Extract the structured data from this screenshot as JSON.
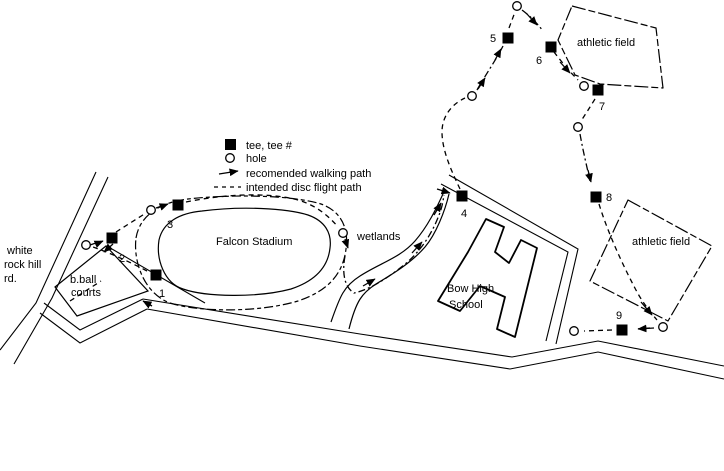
{
  "colors": {
    "ink": "#000000",
    "background": "#ffffff"
  },
  "legend": {
    "text_x": 246,
    "icon_x": 225,
    "items": [
      {
        "type": "tee",
        "label": "tee, tee #",
        "y": 149
      },
      {
        "type": "hole",
        "label": "hole",
        "y": 162
      },
      {
        "type": "walk",
        "label": "recomended walking path",
        "y": 177
      },
      {
        "type": "flight",
        "label": "intended disc flight path",
        "y": 191
      }
    ]
  },
  "map": {
    "labels": [
      {
        "name": "road-name-line-1",
        "text": "white",
        "x": 7,
        "y": 254
      },
      {
        "name": "road-name-line-2",
        "text": "rock hill",
        "x": 4,
        "y": 268
      },
      {
        "name": "road-name-line-3",
        "text": "rd.",
        "x": 4,
        "y": 282
      },
      {
        "name": "bball-courts-label-1",
        "text": "b.ball",
        "x": 70,
        "y": 283
      },
      {
        "name": "bball-courts-label-2",
        "text": "courts",
        "x": 71,
        "y": 296
      },
      {
        "name": "falcon-stadium-label",
        "text": "Falcon Stadium",
        "x": 216,
        "y": 245
      },
      {
        "name": "wetlands-label",
        "text": "wetlands",
        "x": 357,
        "y": 240
      },
      {
        "name": "school-label-1",
        "text": "Bow High",
        "x": 447,
        "y": 292
      },
      {
        "name": "school-label-2",
        "text": "School",
        "x": 449,
        "y": 308
      },
      {
        "name": "athletic-field-1-label",
        "text": "athletic field",
        "x": 577,
        "y": 46
      },
      {
        "name": "athletic-field-2-label",
        "text": "athletic field",
        "x": 632,
        "y": 245
      }
    ],
    "tees": [
      {
        "n": "1",
        "x": 156,
        "y": 275,
        "lx": 162,
        "ly": 297
      },
      {
        "n": "2",
        "x": 112,
        "y": 238,
        "lx": 122,
        "ly": 262
      },
      {
        "n": "3",
        "x": 178,
        "y": 205,
        "lx": 170,
        "ly": 228
      },
      {
        "n": "4",
        "x": 462,
        "y": 196,
        "lx": 464,
        "ly": 217
      },
      {
        "n": "5",
        "x": 508,
        "y": 38,
        "lx": 493,
        "ly": 42
      },
      {
        "n": "6",
        "x": 551,
        "y": 47,
        "lx": 539,
        "ly": 64
      },
      {
        "n": "7",
        "x": 598,
        "y": 90,
        "lx": 602,
        "ly": 110
      },
      {
        "n": "8",
        "x": 596,
        "y": 197,
        "lx": 609,
        "ly": 201
      },
      {
        "n": "9",
        "x": 622,
        "y": 330,
        "lx": 619,
        "ly": 319
      }
    ],
    "holes": [
      {
        "n": "1",
        "x": 86,
        "y": 245
      },
      {
        "n": "2",
        "x": 151,
        "y": 210
      },
      {
        "n": "3",
        "x": 343,
        "y": 233
      },
      {
        "n": "4",
        "x": 472,
        "y": 96
      },
      {
        "n": "5",
        "x": 517,
        "y": 6
      },
      {
        "n": "6",
        "x": 584,
        "y": 86
      },
      {
        "n": "7",
        "x": 578,
        "y": 127
      },
      {
        "n": "8",
        "x": 663,
        "y": 327
      },
      {
        "n": "9",
        "x": 574,
        "y": 331
      }
    ],
    "roads": [
      "M96,172 L36,303 L0,350",
      "M108,177 L52,298 L14,364",
      "M44,303 L80,330 L143,299",
      "M40,313 L80,343 L147,309",
      "M143,299 L360,334 L512,357 L598,341 L724,366",
      "M147,309 L360,346 L510,369 L598,352 L724,379",
      "M449,175 L578,249 L556,344",
      "M441,184 L568,252 L546,341",
      "M112,249 L205,303"
    ],
    "outlines": [
      {
        "name": "stadium-outer-outline",
        "cls": "sketch",
        "d": "M136,238 C140,214 162,202 188,199 C232,194 292,195 321,204 C341,211 349,228 346,249 C343,274 328,291 298,301 C258,313 198,312 170,303 C145,294 133,263 136,238 Z"
      },
      {
        "name": "stadium-inner-outline",
        "cls": "solid",
        "d": "M159,240 C163,222 180,213 202,211 C240,206 286,208 308,215 C325,221 332,233 330,248 C328,267 315,281 291,289 C257,298 206,297 183,289 C164,283 156,259 159,240 Z"
      },
      {
        "name": "wetlands-path-edge-left",
        "cls": "solid",
        "d": "M331,322 C340,296 344,286 360,276 C380,263 400,258 415,241 C428,226 436,209 443,194"
      },
      {
        "name": "wetlands-path-edge-right",
        "cls": "solid",
        "d": "M349,329 C356,301 362,293 376,284 C396,272 412,262 425,247 C436,234 445,211 449,194"
      },
      {
        "name": "bball-courts-outline",
        "cls": "solid",
        "d": "M55,287 L106,246 L148,291 L77,316 Z"
      },
      {
        "name": "school-building-outline",
        "cls": "bldg",
        "d": "M486,219 L504,227 L495,252 L509,263 L521,240 L537,248 L515,337 L497,329 L505,297 L480,286 L460,311 L438,301 L468,252 Z"
      },
      {
        "name": "athletic-field-1-outline",
        "cls": "fieldline",
        "d": "M572,6 L656,28 L663,88 L600,84 L575,75 L558,40 Z"
      },
      {
        "name": "athletic-field-2-outline",
        "cls": "fieldline",
        "d": "M628,200 L712,246 L668,321 L590,281 Z"
      }
    ],
    "flight_paths": [
      "M147,271 C130,262 110,253 93,247",
      "M70,301 L101,281",
      "M116,232 L146,213",
      "M186,202 C225,194 268,192 298,200 C315,205 328,215 338,227",
      "M460,189 C451,170 442,150 442,132 C442,116 452,104 465,98",
      "M509,28 L515,12",
      "M554,52 C561,61 569,71 578,80",
      "M595,99 C590,107 585,115 581,121",
      "M599,204 C607,230 621,262 637,292 C643,303 651,313 657,320",
      "M612,330 L584,331"
    ],
    "walk_paths": [
      "M156,208 L168,204",
      "M90,245 L102,241",
      "M345,256 C342,272 344,287 354,293 C372,289 390,276 404,265 C420,252 432,234 439,215 C442,208 443,201 444,195",
      "M477,90 C486,74 496,60 503,46",
      "M522,10 C530,16 537,23 543,31",
      "M580,134 C583,151 587,167 590,181",
      "M650,328 L636,329"
    ],
    "arrows": [
      [
        345,
        239,
        348,
        248
      ],
      [
        363,
        286,
        375,
        279
      ],
      [
        412,
        253,
        422,
        242
      ],
      [
        434,
        215,
        441,
        203
      ],
      [
        437,
        189,
        450,
        193
      ],
      [
        478,
        89,
        485,
        78
      ],
      [
        495,
        60,
        501,
        49
      ],
      [
        527,
        14,
        537,
        25
      ],
      [
        560,
        62,
        570,
        73
      ],
      [
        588,
        170,
        591,
        182
      ],
      [
        641,
        302,
        652,
        315
      ],
      [
        654,
        328,
        638,
        329
      ],
      [
        152,
        306,
        143,
        301
      ],
      [
        113,
        244,
        104,
        252
      ],
      [
        96,
        244,
        103,
        241
      ],
      [
        160,
        207,
        168,
        204
      ]
    ]
  }
}
